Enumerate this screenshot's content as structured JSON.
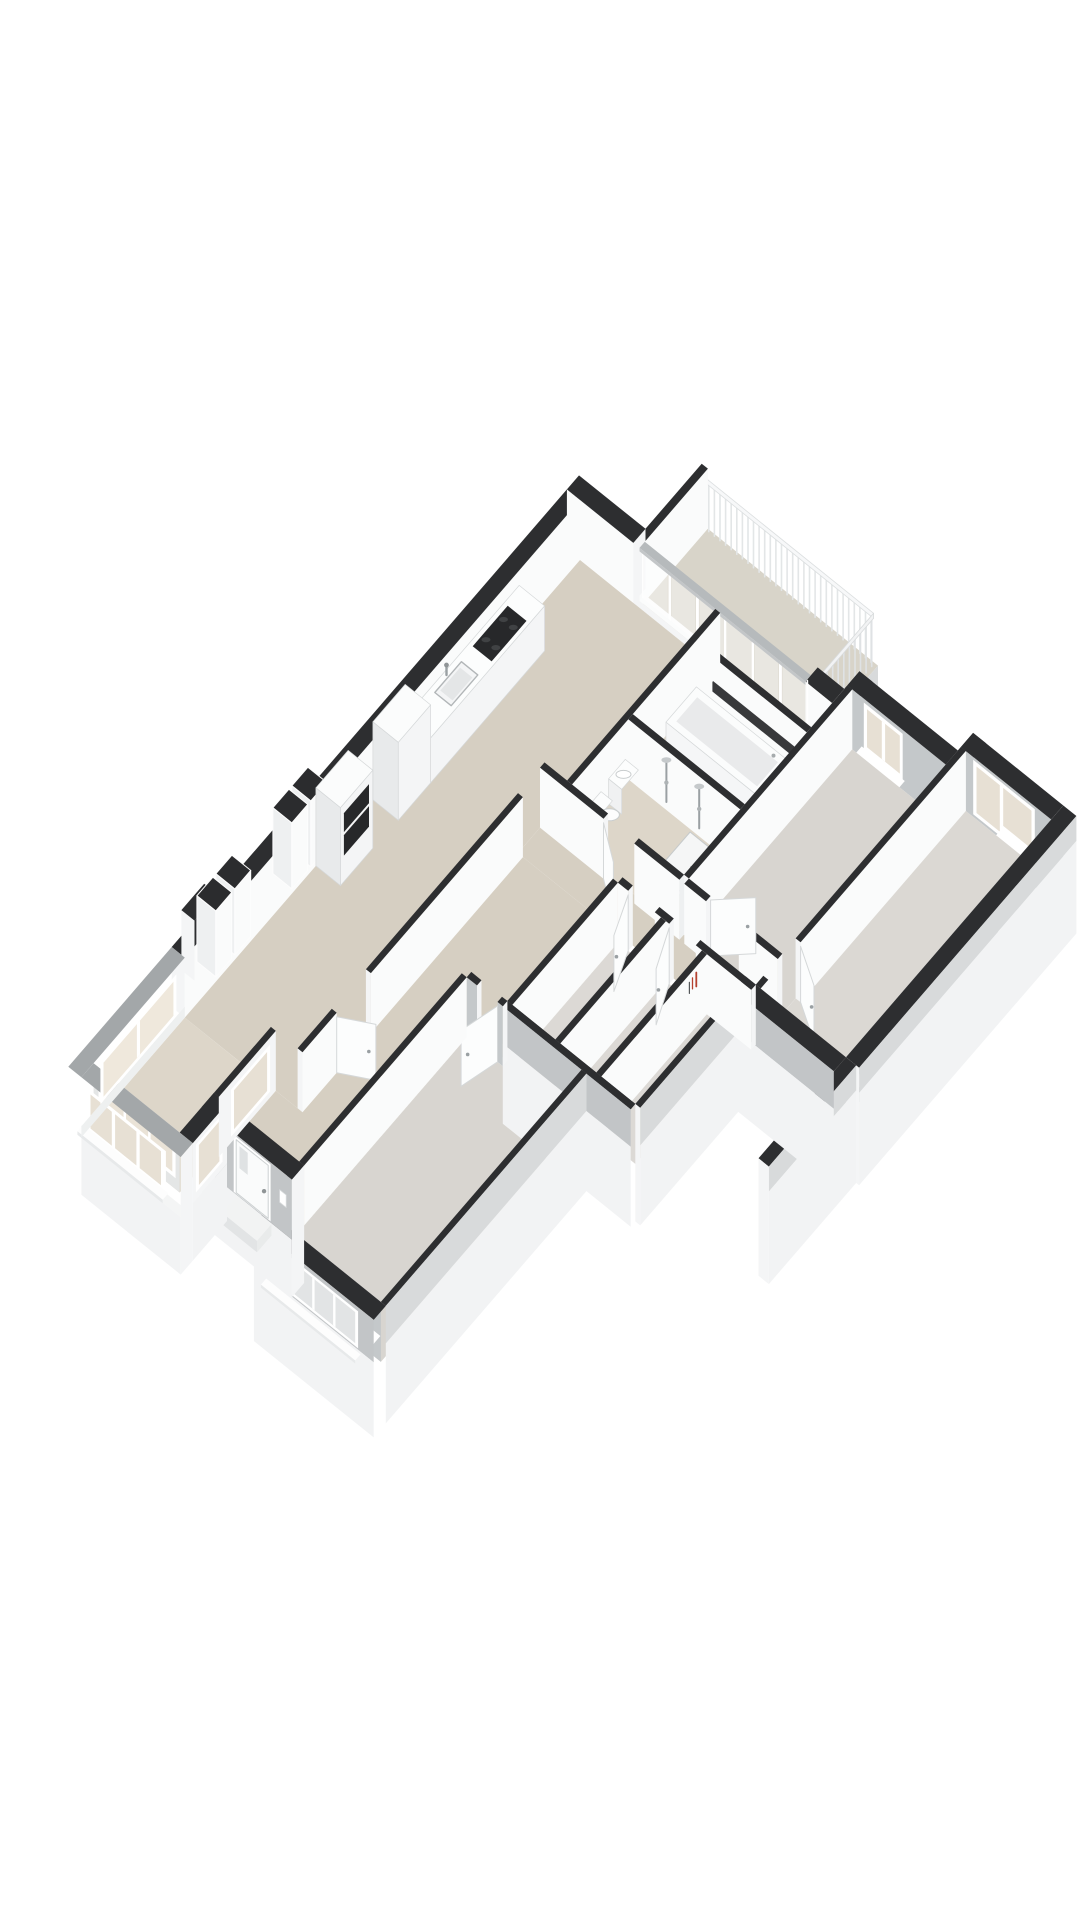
{
  "scene": {
    "type": "isometric-3d-floorplan",
    "description": "3D cutaway floor plan of an apartment rendered on a plain white background",
    "background": "#ffffff"
  },
  "palette": {
    "background": "#ffffff",
    "wall_top_dark": "#2d2e30",
    "wall_top_light": "#a3a7a9",
    "glazing_cap": "#b6babc",
    "face_white": "#fafbfb",
    "face_bright": "#f4f5f6",
    "face_light": "#eef0f1",
    "face_shade": "#c4c8ca",
    "ext_gray": "#c2c5c7",
    "ext_gray_light": "#d8dadb",
    "slab_white": "#f2f3f4",
    "floor_beige": "#d6cfc2",
    "floor_beige_light": "#ddd6c9",
    "floor_gray": "#d8d5d0",
    "floor_gray_light": "#dcd9d5",
    "floor_bed1": "#dbd8d3",
    "floor_balcony": "#d8d4c9",
    "glass_cool": "#edeff0",
    "glass_warm": "#e7e0d4",
    "glass_bay": "#eae3d7",
    "frame_white": "#ffffff",
    "metal_gray": "#9aa0a3",
    "appliance_dark": "#27282a",
    "burner_gray": "#404244",
    "shelf_dark": "#38393b",
    "accent_red": "#b5412f",
    "outline_soft": "#d5d8d9",
    "railing_white": "#f7f8f9",
    "baluster": "#e3e6e7"
  },
  "rooms": [
    {
      "id": "living-dining",
      "floor": "floor_beige"
    },
    {
      "id": "kitchen",
      "floor": "floor_beige"
    },
    {
      "id": "bay-window-nook",
      "floor": "floor_beige_light"
    },
    {
      "id": "hallway",
      "floor": "floor_beige"
    },
    {
      "id": "corridor",
      "floor": "floor_beige"
    },
    {
      "id": "bathroom",
      "floor": "floor_beige_light"
    },
    {
      "id": "laundry-closet",
      "floor": "floor_beige_light"
    },
    {
      "id": "storage-cells",
      "floor": "floor_gray_light"
    },
    {
      "id": "study",
      "floor": "floor_gray"
    },
    {
      "id": "bedroom-1",
      "floor": "floor_bed1"
    },
    {
      "id": "bedroom-2",
      "floor": "floor_gray"
    },
    {
      "id": "balcony",
      "floor": "floor_balcony"
    }
  ],
  "features": {
    "balcony_railing": {
      "balusters_long": 30,
      "balusters_end": 10
    },
    "kitchen": {
      "burners": 4,
      "fixtures": [
        "sink",
        "cooktop",
        "counter",
        "cabinet-tower",
        "oven-cabinet"
      ]
    },
    "bathroom": {
      "fixtures": [
        "bathtub",
        "mirror-shelf",
        "shower-mixers",
        "shower-tray",
        "washbasin",
        "toilet"
      ]
    },
    "doors": {
      "front_door": 1,
      "interior_doors": 7
    },
    "windows": {
      "balcony_glazing_panes": 6,
      "study_windows": 1,
      "bedroom1_facade_windows": 3,
      "bedroom1_glazed_door_panels": 2,
      "bedroom2_panes": 4,
      "bay_outer_panes": 3,
      "ventilation_shafts": 2
    }
  }
}
